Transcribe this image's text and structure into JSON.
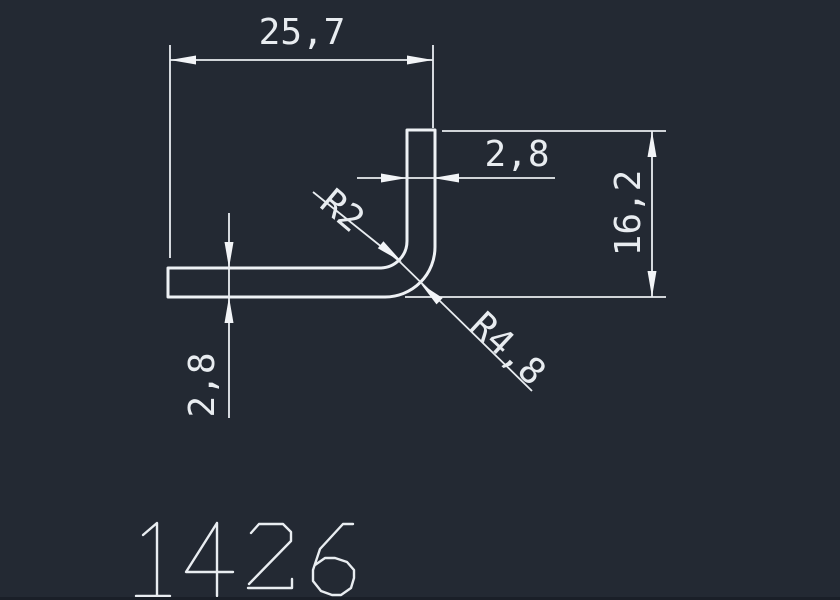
{
  "canvas": {
    "description": "CAD technical drawing of an L-angle profile",
    "background_color": "#232933",
    "line_color": "#e9edf1",
    "part_number": "1426"
  },
  "dimensions": {
    "overall_width": "25,7",
    "overall_height": "16,2",
    "vertical_leg_thickness": "2,8",
    "horizontal_leg_thickness": "2,8",
    "inner_fillet_radius": "R2",
    "outer_fillet_radius": "R4,8"
  }
}
